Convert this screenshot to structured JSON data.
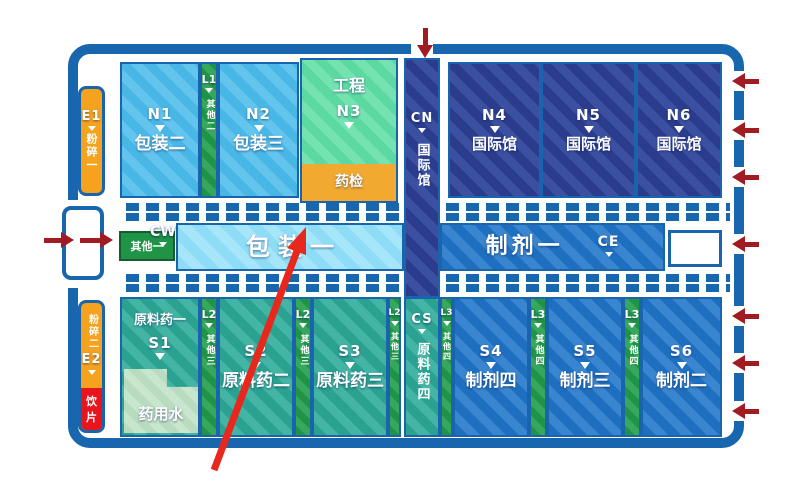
{
  "colors": {
    "frame_blue": "#1766ae",
    "navy_hall": "#2b3c8c",
    "royal_blue_hall": "#1f6fc0",
    "sky_blue_hall": "#49b7e6",
    "light_sky_hall": "#8edcf6",
    "teal_hall": "#2aa191",
    "green_strip": "#1f9447",
    "mint_hall": "#5cd9a0",
    "pale_green_zone": "#b9dcc0",
    "orange_hall": "#f5a21f",
    "red_hall": "#e8151d",
    "entry_arrow_red": "#a01b22",
    "pointer_arrow_red": "#e8271d"
  },
  "halls": {
    "e1": {
      "code": "E1",
      "name": "粉碎一"
    },
    "e2": {
      "code": "E2",
      "name": "粉碎二",
      "sub": "饮片"
    },
    "n1": {
      "code": "N1",
      "name": "包装二"
    },
    "n2": {
      "code": "N2",
      "name": "包装三"
    },
    "n3": {
      "code": "N3",
      "name": "工程",
      "sub": "药检"
    },
    "n4": {
      "code": "N4",
      "name": "国际馆"
    },
    "n5": {
      "code": "N5",
      "name": "国际馆"
    },
    "n6": {
      "code": "N6",
      "name": "国际馆"
    },
    "cn": {
      "code": "CN",
      "name": "国际馆"
    },
    "cw": {
      "code": "CW",
      "name": "其他一"
    },
    "ce": {
      "code": "CE",
      "name": "制剂一"
    },
    "cs": {
      "code": "CS",
      "name": "原料药四"
    },
    "w1": {
      "name": "包装一"
    },
    "l1": {
      "code": "L1",
      "name": "其他二"
    },
    "l2": {
      "code": "L2",
      "name": "其他三"
    },
    "l3": {
      "code": "L3",
      "name": "其他四"
    },
    "s1": {
      "code": "S1",
      "name": "原料药一",
      "sub": "药用水"
    },
    "s2": {
      "code": "S2",
      "name": "原料药二"
    },
    "s3": {
      "code": "S3",
      "name": "原料药三"
    },
    "s4": {
      "code": "S4",
      "name": "制剂四"
    },
    "s5": {
      "code": "S5",
      "name": "制剂三"
    },
    "s6": {
      "code": "S6",
      "name": "制剂二"
    }
  }
}
